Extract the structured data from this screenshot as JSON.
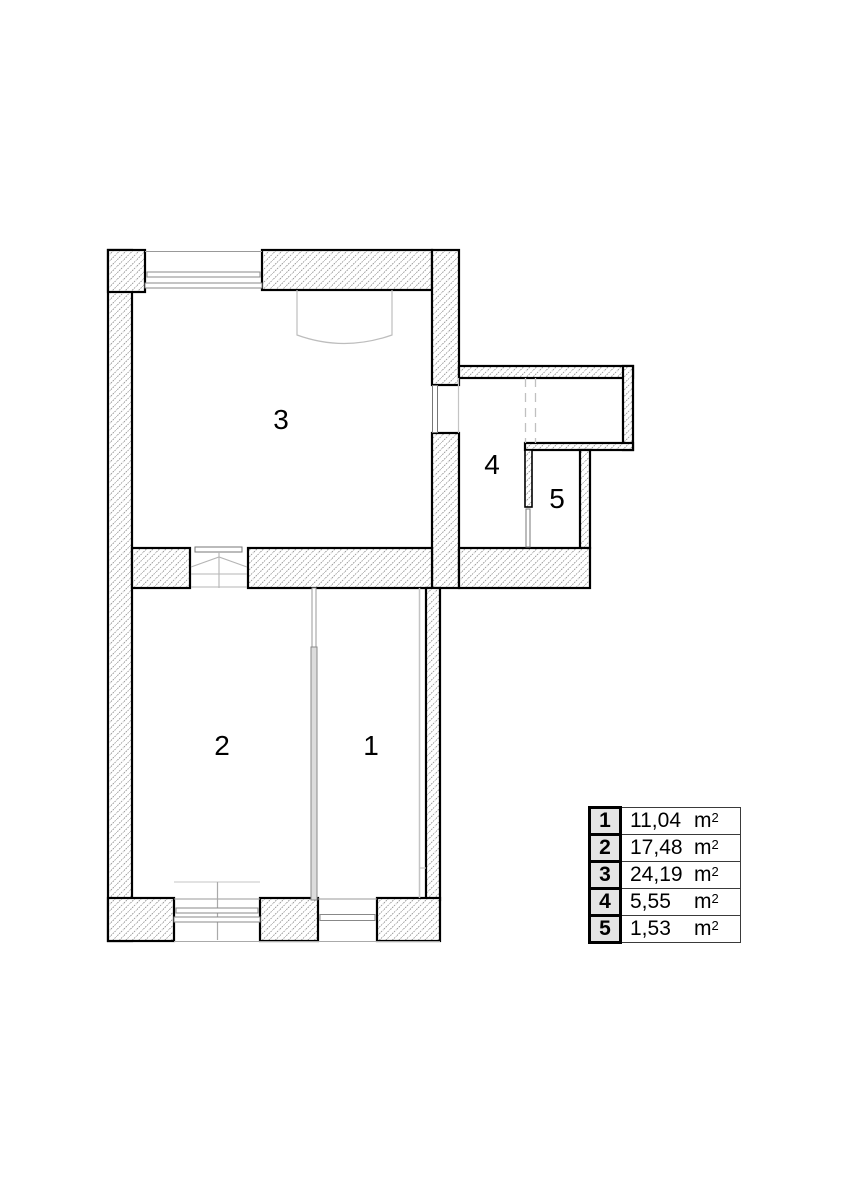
{
  "plan": {
    "rooms": [
      {
        "number": "1",
        "area": "11,04"
      },
      {
        "number": "2",
        "area": "17,48"
      },
      {
        "number": "3",
        "area": "24,19"
      },
      {
        "number": "4",
        "area": "5,55"
      },
      {
        "number": "5",
        "area": "1,53"
      }
    ],
    "unit": "m",
    "unit_sup": "2",
    "colors": {
      "wall_outline": "#000000",
      "hatch_line": "#8f8f8f",
      "legend_number_bg": "#e4e4e4",
      "thin_detail": "#bdbdbd"
    }
  }
}
